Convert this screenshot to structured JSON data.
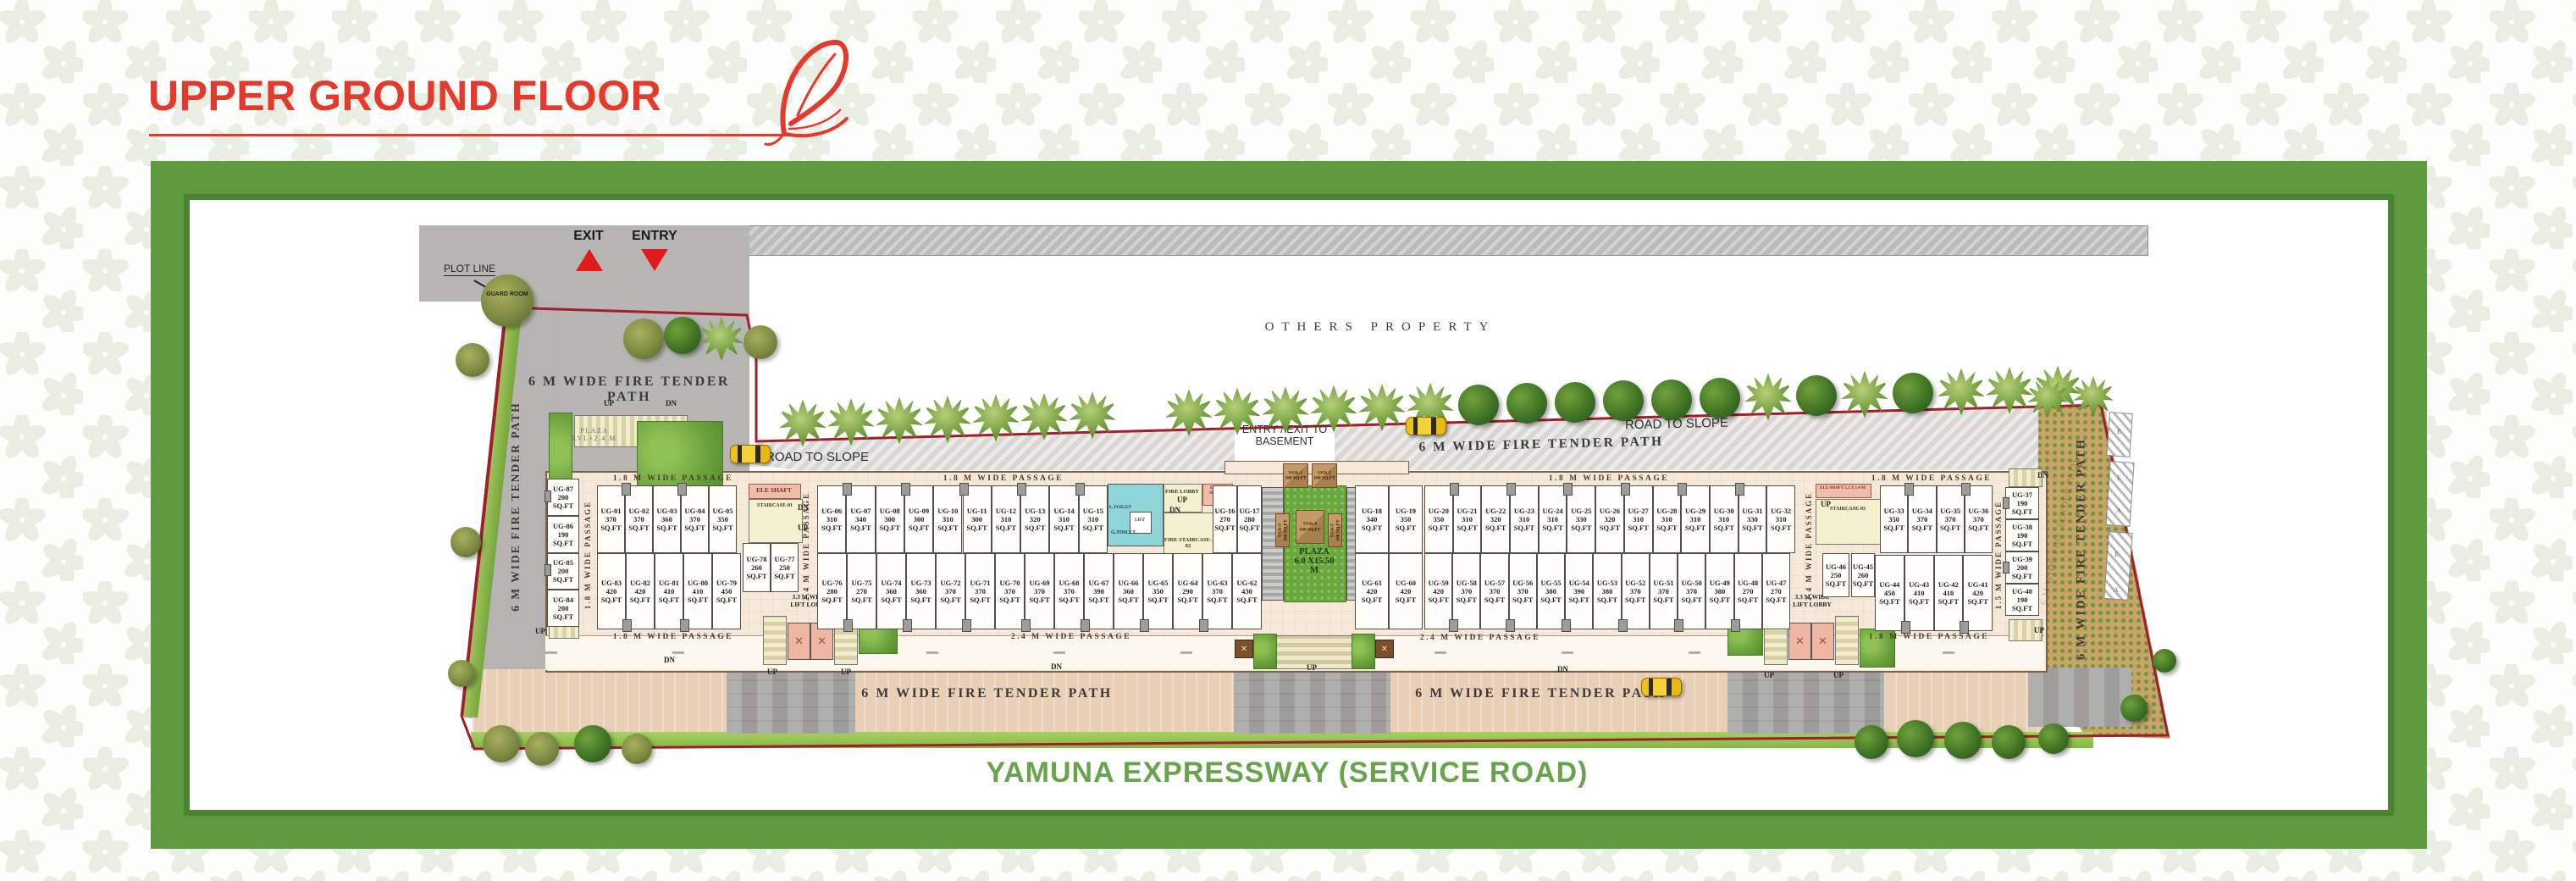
{
  "header": {
    "title": "UPPER GROUND FLOOR"
  },
  "footer": {
    "road_name": "YAMUNA EXPRESSWAY (SERVICE ROAD)"
  },
  "colors": {
    "accent_red": "#e5392c",
    "frame_green": "#5f9a41",
    "footer_green": "#68a44c",
    "plot_line_red": "#a11f2c"
  },
  "plan": {
    "unit_suffix": "SQ.FT",
    "area_labels": {
      "others_property": "OTHERS PROPERTY",
      "entry_exit_basement": "ENTRY / EXIT TO\nBASEMENT",
      "road_to_slope_left": "ROAD TO SLOPE",
      "road_to_slope_right": "ROAD TO SLOPE",
      "fire_path_left_block": "6 M WIDE FIRE TENDER PATH",
      "fire_path_left_vertical": "6 M WIDE FIRE TENDER PATH",
      "fire_path_top": "6 M WIDE FIRE TENDER PATH",
      "fire_path_bottom_left": "6 M WIDE FIRE TENDER PATH",
      "fire_path_bottom_right": "6 M WIDE FIRE TENDER PATH",
      "fire_path_right_vertical": "6 M WIDE FIRE TENDER PATH",
      "exit": "EXIT",
      "entry": "ENTRY",
      "plot_line": "PLOT LINE",
      "guard_room": "GUARD ROOM",
      "plaza_upper": "PLAZA\nLVL+2.4 M",
      "plaza_center": "PLAZA\n6.0 X15.50\nM",
      "lift_lobby_left": "3.3 M WIDE\nLIFT LOBBY",
      "lift_lobby_right": "3.3 M WIDE\nLIFT LOBBY",
      "up": "UP",
      "dn": "DN"
    },
    "passages": {
      "p18": "1.8 M WIDE PASSAGE",
      "p24": "2.4 M WIDE PASSAGE",
      "p15": "1.5 M WIDE PASSAGE"
    },
    "cores": {
      "core1": {
        "ele_shaft": "ELE SHAFT",
        "staircase": "STAIRCASE-01"
      },
      "core2": {
        "l_toilet": "L.TOILET",
        "g_toilet": "G.TOILET",
        "lift": "LIFT",
        "fire_lobby": "FIRE LOBBY",
        "elec_shaft": "ELEC. SHAFT",
        "staircase": "FIRE STAIRCASE-02"
      },
      "core3": {
        "ele_shaft": "ELE SHAFT 5.2 X 1.4 M",
        "staircase": "STAIRCASE-03"
      }
    },
    "ramp_letters": [
      "E",
      "E",
      "A",
      "E",
      "A"
    ],
    "kiosks": [
      {
        "id": "UGk-1",
        "area": "160"
      },
      {
        "id": "UGk-2",
        "area": "160"
      },
      {
        "id": "UGk-3",
        "area": "160"
      },
      {
        "id": "UGk-4",
        "area": "160"
      },
      {
        "id": "UGk-5",
        "area": "160"
      }
    ],
    "strips": {
      "left_column": [
        {
          "id": "UG-87",
          "area": "200"
        },
        {
          "id": "UG-86",
          "area": "190"
        },
        {
          "id": "UG-85",
          "area": "200"
        },
        {
          "id": "UG-84",
          "area": "200"
        }
      ],
      "a_top": [
        {
          "id": "UG-01",
          "area": "370"
        },
        {
          "id": "UG-02",
          "area": "370"
        },
        {
          "id": "UG-03",
          "area": "360"
        },
        {
          "id": "UG-04",
          "area": "370"
        },
        {
          "id": "UG-05",
          "area": "350"
        }
      ],
      "a_small": [
        {
          "id": "UG-78",
          "area": "260"
        },
        {
          "id": "UG-77",
          "area": "250"
        }
      ],
      "a_bottom": [
        {
          "id": "UG-83",
          "area": "420"
        },
        {
          "id": "UG-82",
          "area": "420"
        },
        {
          "id": "UG-81",
          "area": "410"
        },
        {
          "id": "UG-80",
          "area": "410"
        },
        {
          "id": "UG-79",
          "area": "450"
        }
      ],
      "b_top": [
        {
          "id": "UG-06",
          "area": "310"
        },
        {
          "id": "UG-07",
          "area": "340"
        },
        {
          "id": "UG-08",
          "area": "300"
        },
        {
          "id": "UG-09",
          "area": "300"
        },
        {
          "id": "UG-10",
          "area": "310"
        },
        {
          "id": "UG-11",
          "area": "300"
        },
        {
          "id": "UG-12",
          "area": "310"
        },
        {
          "id": "UG-13",
          "area": "320"
        },
        {
          "id": "UG-14",
          "area": "310"
        },
        {
          "id": "UG-15",
          "area": "310"
        }
      ],
      "b_top_right": [
        {
          "id": "UG-16",
          "area": "270"
        },
        {
          "id": "UG-17",
          "area": "280"
        }
      ],
      "b_bottom": [
        {
          "id": "UG-76",
          "area": "280"
        },
        {
          "id": "UG-75",
          "area": "270"
        },
        {
          "id": "UG-74",
          "area": "360"
        },
        {
          "id": "UG-73",
          "area": "360"
        },
        {
          "id": "UG-72",
          "area": "370"
        },
        {
          "id": "UG-71",
          "area": "370"
        },
        {
          "id": "UG-70",
          "area": "370"
        },
        {
          "id": "UG-69",
          "area": "370"
        },
        {
          "id": "UG-68",
          "area": "370"
        },
        {
          "id": "UG-67",
          "area": "390"
        },
        {
          "id": "UG-66",
          "area": "360"
        },
        {
          "id": "UG-65",
          "area": "350"
        },
        {
          "id": "UG-64",
          "area": "290"
        },
        {
          "id": "UG-63",
          "area": "370"
        },
        {
          "id": "UG-62",
          "area": "430"
        }
      ],
      "plaza_top": [
        {
          "id": "UG-18",
          "area": "340"
        },
        {
          "id": "UG-19",
          "area": "350"
        }
      ],
      "plaza_bottom": [
        {
          "id": "UG-61",
          "area": "420"
        },
        {
          "id": "UG-60",
          "area": "420"
        }
      ],
      "c_top": [
        {
          "id": "UG-20",
          "area": "350"
        },
        {
          "id": "UG-21",
          "area": "310"
        },
        {
          "id": "UG-22",
          "area": "320"
        },
        {
          "id": "UG-23",
          "area": "310"
        },
        {
          "id": "UG-24",
          "area": "310"
        },
        {
          "id": "UG-25",
          "area": "330"
        },
        {
          "id": "UG-26",
          "area": "320"
        },
        {
          "id": "UG-27",
          "area": "310"
        },
        {
          "id": "UG-28",
          "area": "310"
        },
        {
          "id": "UG-29",
          "area": "310"
        },
        {
          "id": "UG-30",
          "area": "310"
        },
        {
          "id": "UG-31",
          "area": "330"
        },
        {
          "id": "UG-32",
          "area": "310"
        }
      ],
      "c_bottom": [
        {
          "id": "UG-59",
          "area": "420"
        },
        {
          "id": "UG-58",
          "area": "370"
        },
        {
          "id": "UG-57",
          "area": "370"
        },
        {
          "id": "UG-56",
          "area": "370"
        },
        {
          "id": "UG-55",
          "area": "380"
        },
        {
          "id": "UG-54",
          "area": "390"
        },
        {
          "id": "UG-53",
          "area": "380"
        },
        {
          "id": "UG-52",
          "area": "370"
        },
        {
          "id": "UG-51",
          "area": "370"
        },
        {
          "id": "UG-50",
          "area": "370"
        },
        {
          "id": "UG-49",
          "area": "380"
        },
        {
          "id": "UG-48",
          "area": "270"
        },
        {
          "id": "UG-47",
          "area": "270"
        }
      ],
      "d_46": [
        {
          "id": "UG-46",
          "area": "250"
        }
      ],
      "d_top": [
        {
          "id": "UG-33",
          "area": "350"
        },
        {
          "id": "UG-34",
          "area": "370"
        },
        {
          "id": "UG-35",
          "area": "370"
        },
        {
          "id": "UG-36",
          "area": "370"
        }
      ],
      "d_45": [
        {
          "id": "UG-45",
          "area": "260"
        }
      ],
      "d_bottom": [
        {
          "id": "UG-44",
          "area": "450"
        },
        {
          "id": "UG-43",
          "area": "410"
        },
        {
          "id": "UG-42",
          "area": "410"
        },
        {
          "id": "UG-41",
          "area": "420"
        }
      ],
      "e_column": [
        {
          "id": "UG-37",
          "area": "190"
        },
        {
          "id": "UG-38",
          "area": "190"
        },
        {
          "id": "UG-39",
          "area": "200"
        },
        {
          "id": "UG-40",
          "area": "190"
        }
      ]
    }
  }
}
